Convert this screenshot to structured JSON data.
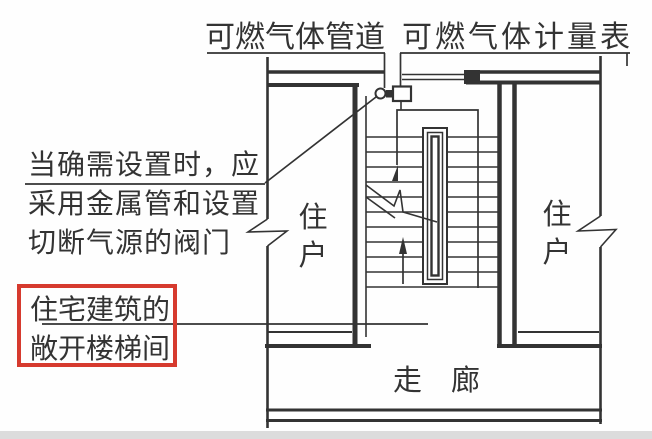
{
  "figure": {
    "background": "#fefefe",
    "ink_color": "#333333",
    "highlight_color": "#d63a2e",
    "annotations": {
      "gas_pipeline_label": "可燃气体管道",
      "gas_meter_label": "可燃气体计量表",
      "note_line1": "当确需设置时，应",
      "note_line2": "采用金属管和设置",
      "note_line3": "切断气源的阀门",
      "highlight_line1": "住宅建筑的",
      "highlight_line2": "敞开楼梯间",
      "corridor_label": "走廊",
      "unit_left_chars": [
        "住",
        "户"
      ],
      "unit_right_chars": [
        "住",
        "户"
      ]
    },
    "icons": {
      "valve": "shutoff-valve-symbol",
      "meter": "gas-meter-symbol",
      "stair_arrow": "stair-up-arrow",
      "wall_breaks": "wall-break-symbol"
    }
  }
}
